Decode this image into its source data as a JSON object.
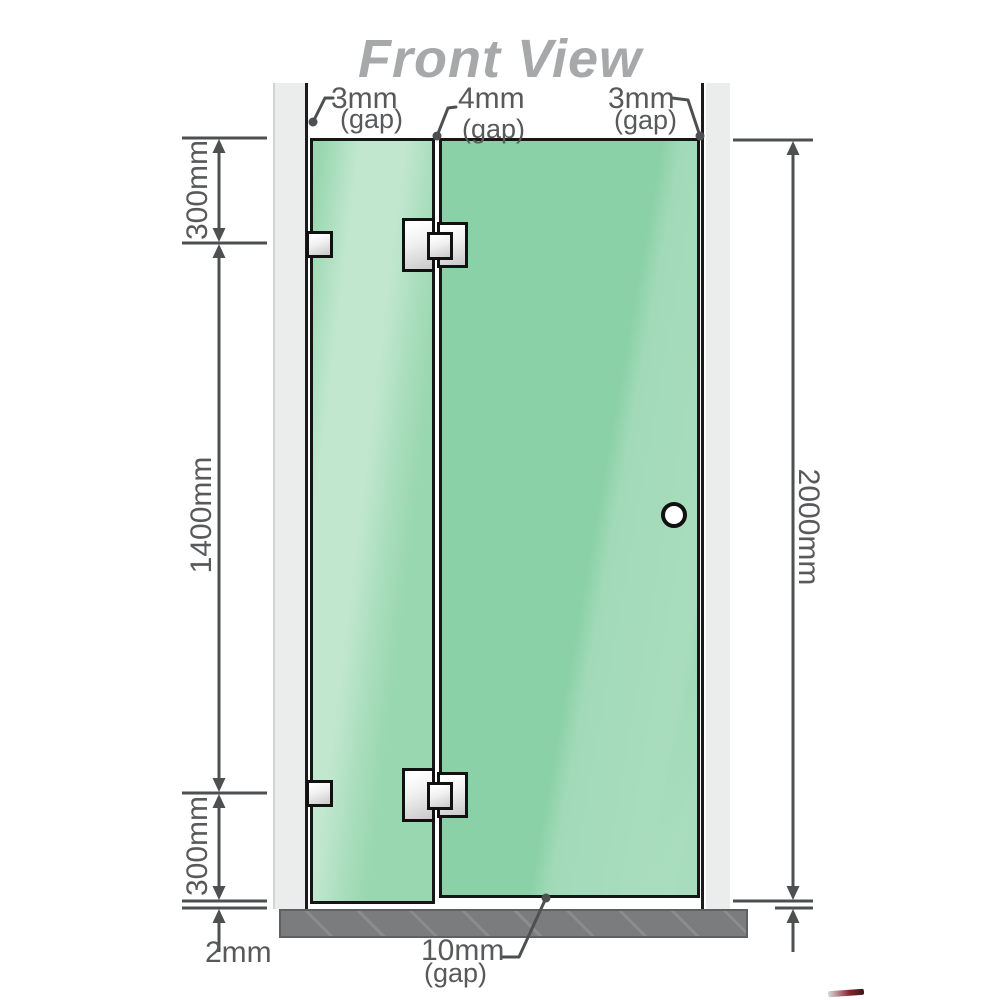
{
  "title": "Front View",
  "labels": {
    "gap_left": {
      "value": "3mm",
      "qualifier": "(gap)"
    },
    "gap_middle": {
      "value": "4mm",
      "qualifier": "(gap)"
    },
    "gap_right": {
      "value": "3mm",
      "qualifier": "(gap)"
    },
    "gap_bottom": {
      "value": "10mm",
      "qualifier": "(gap)"
    }
  },
  "dimensions": {
    "left_top": "300mm",
    "left_middle": "1400mm",
    "left_bottom": "300mm",
    "right_overall": "2000mm",
    "floor_gap": "2mm"
  },
  "colors": {
    "glass_green": "#8bd1a7",
    "glass_highlight": "#c2e7cf",
    "wall_gray": "#ebecec",
    "floor_gray": "#7b7c7e",
    "line_gray": "#4e4f51",
    "text_gray": "#58595b",
    "title_gray": "#a7a8aa",
    "hardware_metal": "#e3e3e3",
    "outline_black": "#161616"
  }
}
